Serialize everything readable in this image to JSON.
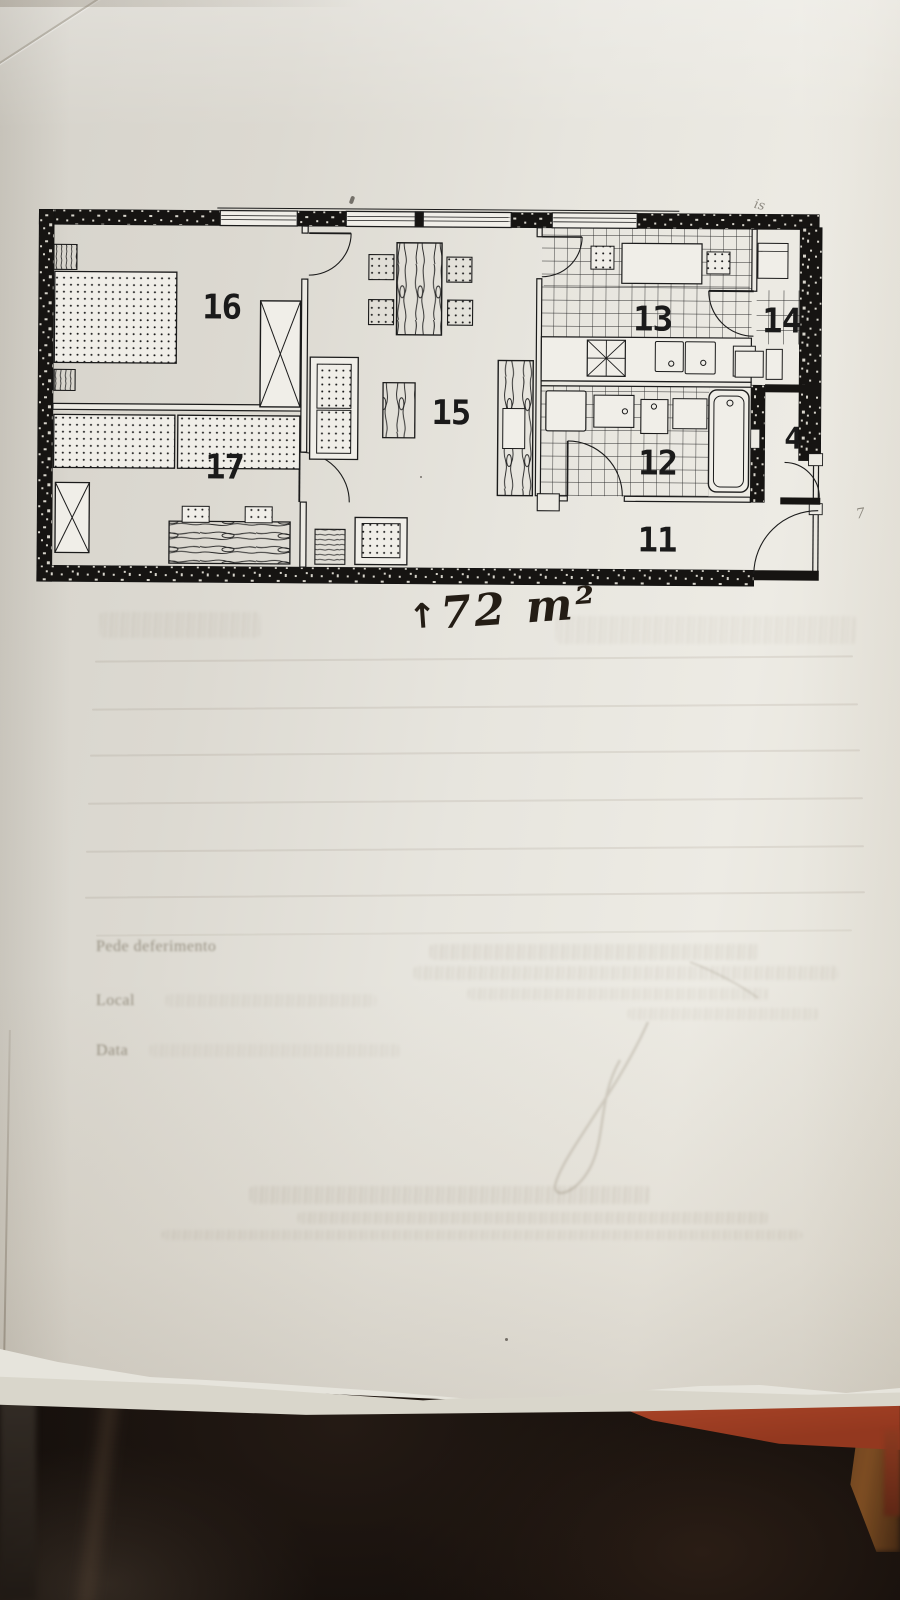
{
  "photo": {
    "colors": {
      "paper": "#e8e6df",
      "ink": "#1b1b1b",
      "fabric_background": "#17110e",
      "orange_object": "#a84427",
      "wood_surface": "#7a4a22"
    }
  },
  "floor_plan": {
    "room_labels": {
      "r16": "16",
      "r17": "17",
      "r15": "15",
      "r13": "13",
      "r14": "14",
      "r12": "12",
      "r11": "11",
      "r4": "4"
    },
    "area_annotation": {
      "arrow": "↑",
      "text": "72 m²"
    }
  },
  "ghost_text": {
    "plea": "Pede deferimento",
    "place_label": "Local",
    "date_label": "Data"
  },
  "pencil_marks": {
    "near_plan_top_right": "is",
    "right_margin": "7"
  }
}
